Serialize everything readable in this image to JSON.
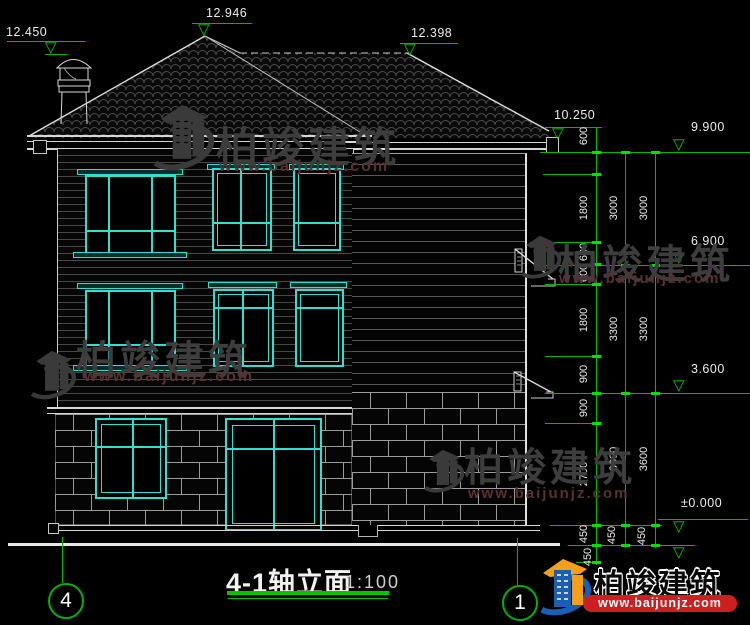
{
  "drawing": {
    "title": "4-1轴立面",
    "scale": "1:100",
    "grid_bubbles": {
      "left": "4",
      "right": "1"
    }
  },
  "elevations": {
    "chimney_top": "12.450",
    "ridge_main": "12.946",
    "ridge_rear": "12.398",
    "eave": "10.250",
    "level_9900": "9.900",
    "level_6900": "6.900",
    "level_3600": "3.600",
    "level_zero": "±0.000"
  },
  "dimensions": {
    "inner": [
      "600",
      "1800",
      "600",
      "600",
      "1800",
      "900",
      "900",
      "2700",
      "450",
      "450"
    ],
    "middle": [
      "3000",
      "3300",
      "3600",
      "450"
    ],
    "outer": [
      "3000",
      "3300",
      "3600",
      "450"
    ]
  },
  "watermark": {
    "brand": "柏竣建筑",
    "url": "www.baijunjz.com"
  },
  "logo": {
    "brand": "柏竣建筑",
    "url": "www.baijunjz.com"
  },
  "colors": {
    "window_frame": "#2FE0D0",
    "dimension_green": "#00B800",
    "line_white": "#D6D6D6",
    "logo_blue": "#1A5FB4",
    "logo_orange": "#F59F1B",
    "logo_red": "#CC2020"
  }
}
